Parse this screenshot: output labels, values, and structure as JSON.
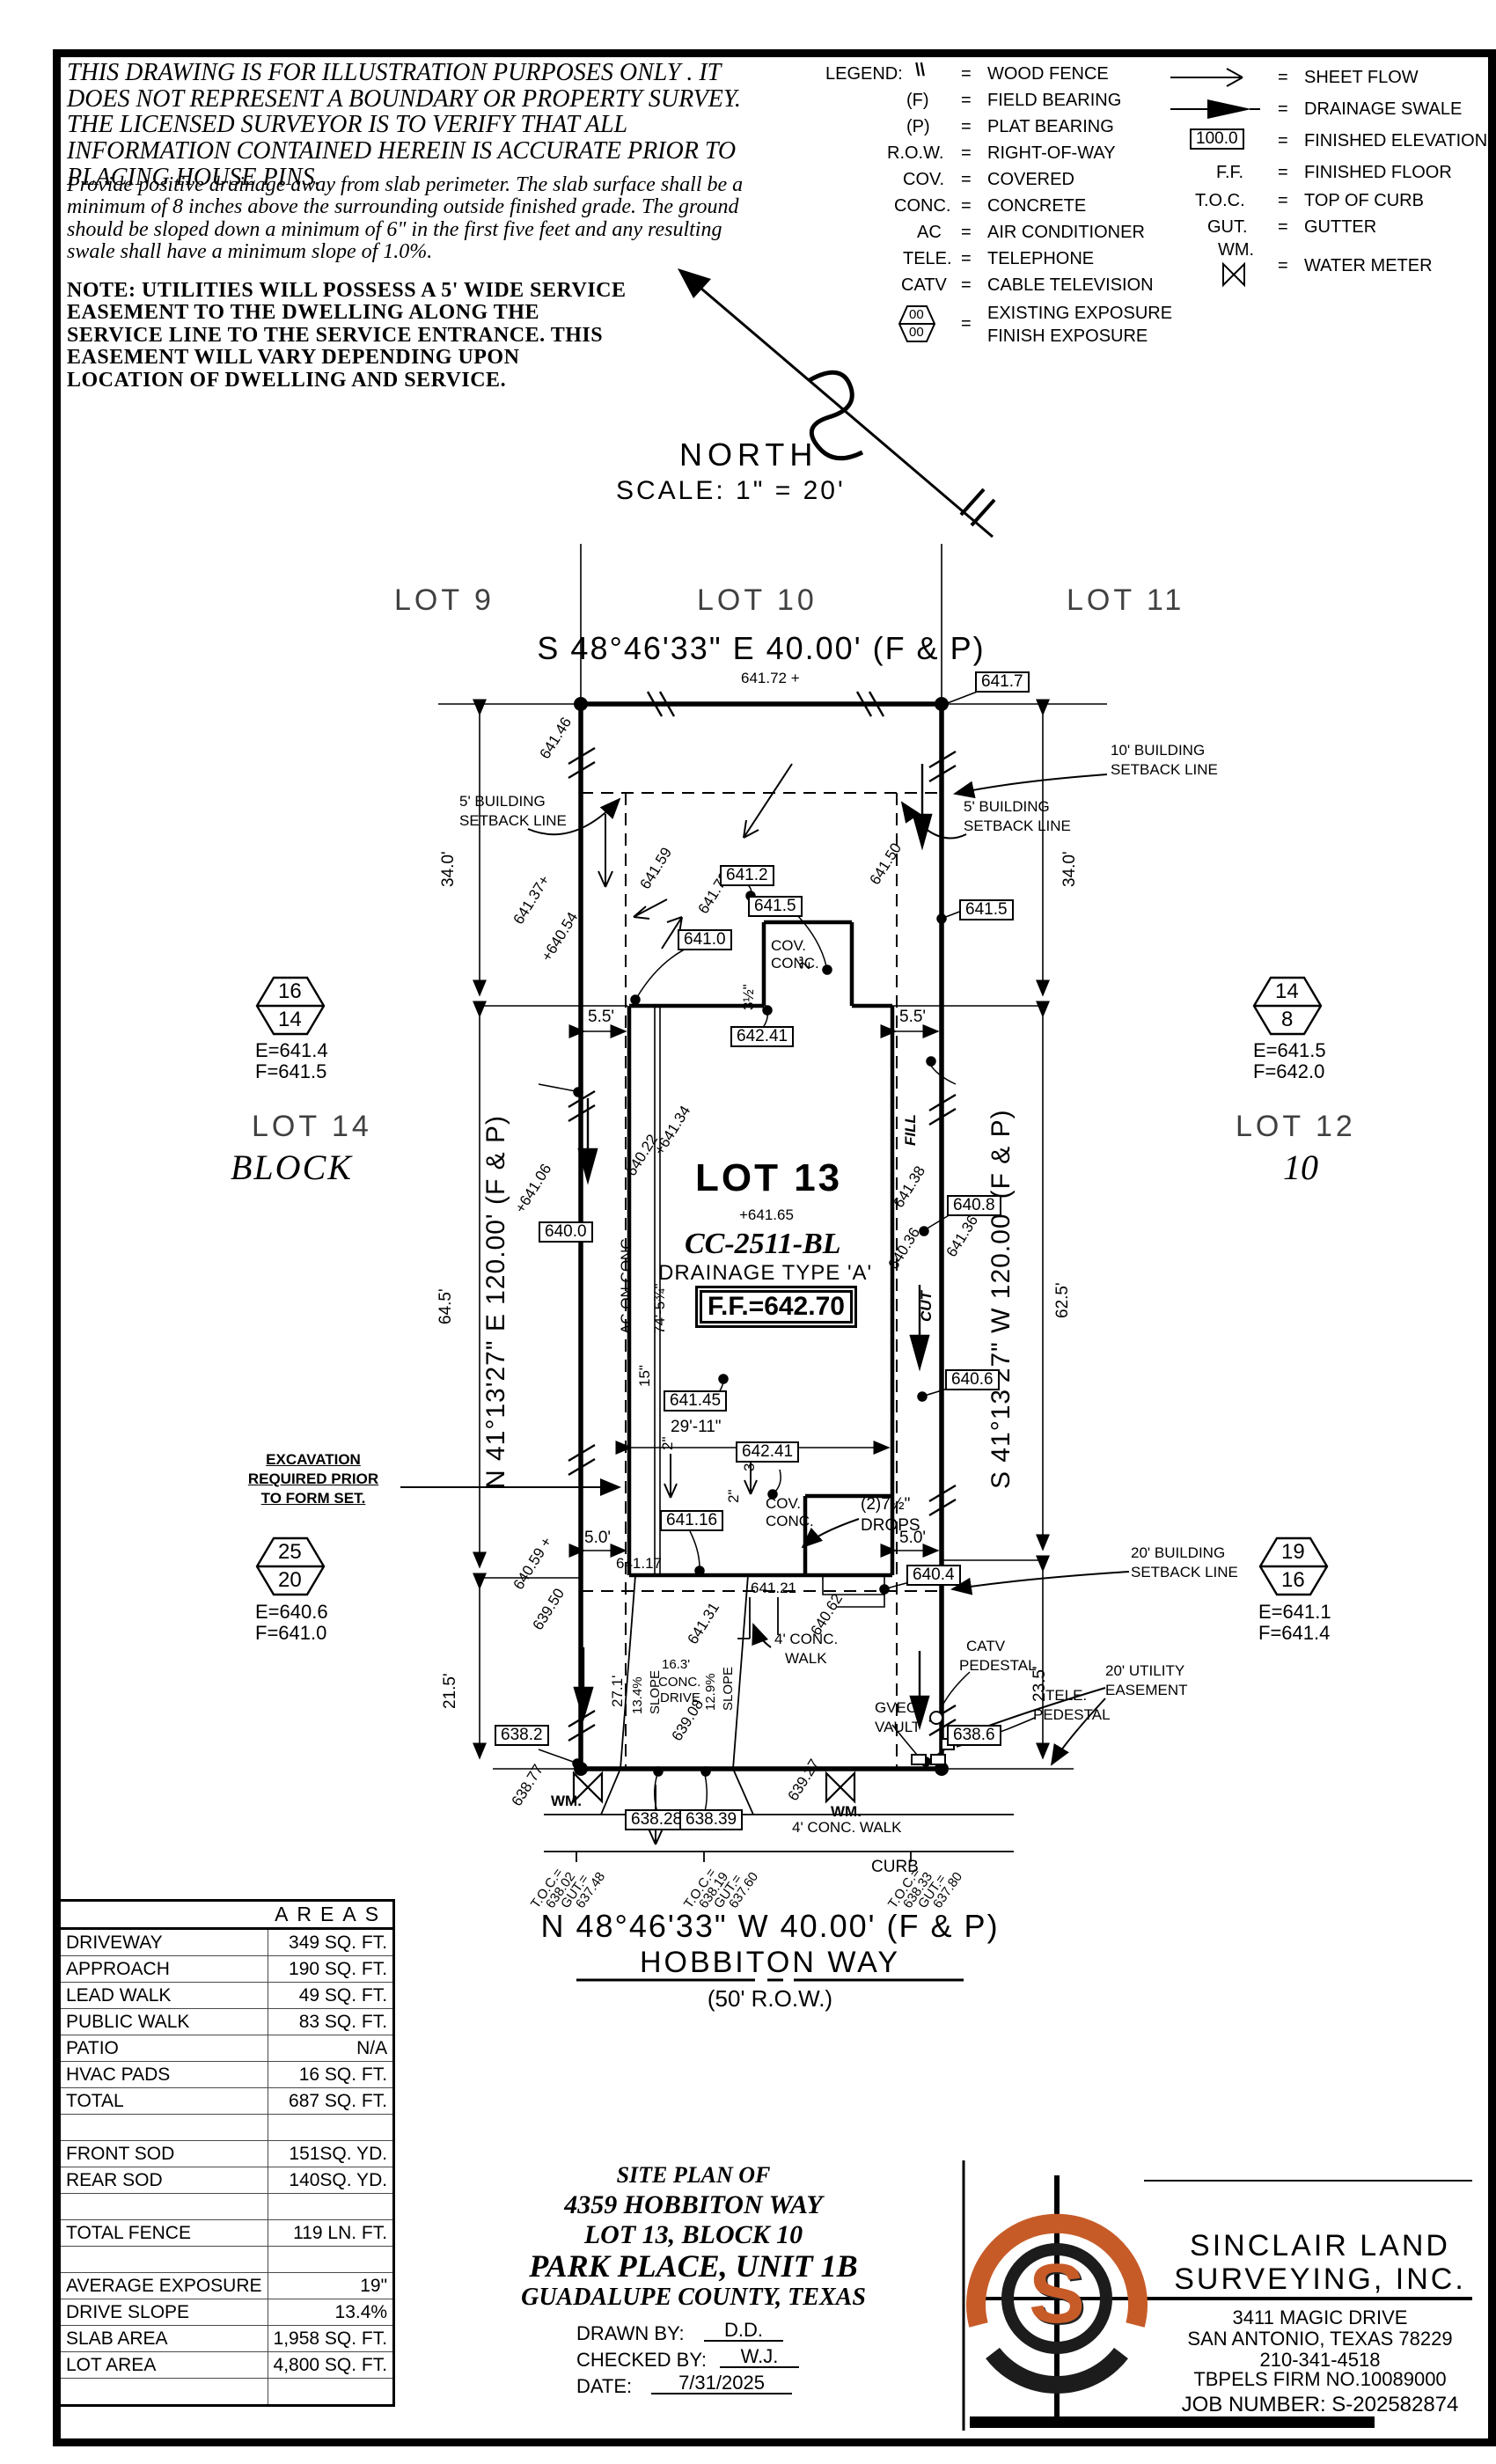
{
  "sheet": {
    "disclaimer_caps": "THIS DRAWING IS FOR ILLUSTRATION PURPOSES ONLY . IT DOES NOT REPRESENT A BOUNDARY OR PROPERTY SURVEY. THE LICENSED SURVEYOR IS TO VERIFY THAT ALL INFORMATION CONTAINED HEREIN IS ACCURATE PRIOR TO PLACING HOUSE PINS.",
    "drainage_note": "Provide positive drainage away from slab perimeter. The slab surface shall be a minimum of 8 inches above the surrounding outside finished grade. The ground should be sloped down a minimum of 6\" in the first five feet and any resulting swale shall have a minimum slope of 1.0%.",
    "utility_note": "NOTE: UTILITIES WILL POSSESS A 5' WIDE SERVICE EASEMENT TO THE DWELLING ALONG THE SERVICE LINE TO THE SERVICE ENTRANCE. THIS EASEMENT WILL VARY DEPENDING UPON LOCATION OF DWELLING AND SERVICE."
  },
  "legend": {
    "title": "LEGEND:",
    "left": [
      {
        "sym": "\\\\",
        "label": "WOOD FENCE"
      },
      {
        "sym": "(F)",
        "label": "FIELD BEARING"
      },
      {
        "sym": "(P)",
        "label": "PLAT BEARING"
      },
      {
        "sym": "R.O.W.",
        "label": "RIGHT-OF-WAY"
      },
      {
        "sym": "COV.",
        "label": "COVERED"
      },
      {
        "sym": "CONC.",
        "label": "CONCRETE"
      },
      {
        "sym": "AC",
        "label": "AIR CONDITIONER"
      },
      {
        "sym": "TELE.",
        "label": "TELEPHONE"
      },
      {
        "sym": "CATV",
        "label": "CABLE TELEVISION"
      }
    ],
    "hex": {
      "top": "00",
      "bottom": "00",
      "label1": "EXISTING EXPOSURE",
      "label2": "FINISH EXPOSURE"
    },
    "right": [
      {
        "sym": "",
        "label": "SHEET FLOW"
      },
      {
        "sym": "",
        "label": "DRAINAGE SWALE"
      },
      {
        "sym": "100.0",
        "label": "FINISHED ELEVATION"
      },
      {
        "sym": "F.F.",
        "label": "FINISHED FLOOR"
      },
      {
        "sym": "T.O.C.",
        "label": "TOP OF CURB"
      },
      {
        "sym": "GUT.",
        "label": "GUTTER"
      },
      {
        "sym": "WM.",
        "label": "WATER METER"
      }
    ]
  },
  "north": {
    "label": "NORTH",
    "scale": "SCALE: 1\" = 20'"
  },
  "plan": {
    "labels": {
      "lot9": "LOT 9",
      "lot10": "LOT 10",
      "lot11": "LOT 11",
      "bearing_top": "S 48°46'33\" E 40.00' (F & P)",
      "r641_72": "641.72 +",
      "b641_7": "641.7",
      "r641_46": "641.46",
      "s10a": "10' BUILDING",
      "s10b": "SETBACK LINE",
      "d34l": "34.0'",
      "d34r": "34.0'",
      "s5la": "5' BUILDING",
      "s5lb": "SETBACK LINE",
      "s5ra": "5' BUILDING",
      "s5rb": "SETBACK LINE",
      "r641_59": "641.59",
      "b641_2": "641.2",
      "r641_73": "641.73",
      "r641_50": "641.50",
      "b641_5a": "641.5",
      "b641_5b": "641.5",
      "b641_0a": "641.0",
      "r641_37": "641.37+",
      "r640_54": "+640.54",
      "cov1a": "COV.",
      "cov1b": "CONC.",
      "d2a": "2\"",
      "d3ha": "3½\"",
      "d5_5l": "5.5'",
      "d5_5r": "5.5'",
      "b642_41a": "642.41",
      "lot14": "LOT 14",
      "block": "BLOCK",
      "lot12": "LOT 12",
      "block10": "10",
      "bearingL": "N 41°13'27\" E 120.00' (F & P)",
      "bearingR": "S 41°13'27\" W 120.00' (F & P)",
      "fill": "FILL",
      "cut": "CUT",
      "lot13": "LOT 13",
      "spot65": "+641.65",
      "model": "CC-2511-BL",
      "drainage": "DRAINAGE TYPE 'A'",
      "ff": "F.F.=642.70",
      "r640_22": "640.22",
      "r641_34": "+641.34",
      "r641_06": "+641.06",
      "b640_0": "640.0",
      "acconc": "AC ON CONC.",
      "d74": "74'-5¾\"",
      "r641_38": "641.38",
      "r640_36": "640.36",
      "r641_36": "641.36 +",
      "b640_8": "640.8",
      "d15": "15\"",
      "b641_45": "641.45",
      "d29_11": "29'-11\"",
      "b642_41b": "642.41",
      "d3hb": "3½\"",
      "d2b": "2\"",
      "d2c": "2\"",
      "b640_6": "640.6",
      "cov2a": "COV.",
      "cov2b": "CONC.",
      "drops1": "(2)7½\"",
      "drops2": "DROPS",
      "b641_16": "641.16",
      "d5_0l": "5.0'",
      "d5_0r": "5.0'",
      "e641_17": "641.17",
      "e641_21": "641.21",
      "b640_4": "640.4",
      "s20a": "20' BUILDING",
      "s20b": "SETBACK LINE",
      "ex1": "EXCAVATION",
      "ex2": "REQUIRED PRIOR",
      "ex3": "TO FORM SET.",
      "d64_5": "64.5'",
      "d62_5": "62.5'",
      "d21_5": "21.5'",
      "d23_5": "23.5'",
      "d27_1": "27.1'",
      "r640_59": "640.59 +",
      "r639_50": "639.50",
      "r641_31": "641.31",
      "r640_62": "640.62",
      "slope1a": "13.4%",
      "slope1b": "SLOPE",
      "slope2a": "12.9%",
      "slope2b": "SLOPE",
      "d16_3": "16.3'",
      "dconc": "CONC.",
      "ddrive": "DRIVE",
      "walk1": "4' CONC.",
      "walk2": "WALK",
      "catv1": "CATV",
      "catv2": "PEDESTAL",
      "tele1": "TELE.",
      "tele2": "PEDESTAL",
      "gvec1": "GVEC.",
      "gvec2": "VAULT",
      "uea": "20' UTILITY",
      "ueb": "EASEMENT",
      "r638_77": "638.77",
      "r639_08": "639.08",
      "r639_27": "639.27",
      "b638_2": "638.2",
      "b638_6": "638.6",
      "wm1": "WM.",
      "wm2": "WM.",
      "b638_28": "638.28",
      "b638_39": "638.39",
      "pubwalk": "4' CONC. WALK",
      "curb": "CURB",
      "toc1a": "T.O.C.=",
      "toc1b": "638.02",
      "toc1c": "GUT.=",
      "toc1d": "637.48",
      "toc2a": "T.O.C.=",
      "toc2b": "638.19",
      "toc2c": "GUT.=",
      "toc2d": "637.60",
      "toc3a": "T.O.C.=",
      "toc3b": "638.33",
      "toc3c": "GUT.=",
      "toc3d": "637.80",
      "bearing_bottom": "N 48°46'33\" W 40.00' (F & P)",
      "street": "HOBBITON WAY",
      "row": "(50' R.O.W.)"
    },
    "markers": {
      "hx1t": "16",
      "hx1b": "14",
      "hx1e": "E=641.4",
      "hx1f": "F=641.5",
      "hx2t": "14",
      "hx2b": "8",
      "hx2e": "E=641.5",
      "hx2f": "F=642.0",
      "hx3t": "25",
      "hx3b": "20",
      "hx3e": "E=640.6",
      "hx3f": "F=641.0",
      "hx4t": "19",
      "hx4b": "16",
      "hx4e": "E=641.1",
      "hx4f": "F=641.4"
    }
  },
  "areas": {
    "title": "AREAS",
    "rows": [
      {
        "label": "DRIVEWAY",
        "value": "349 SQ. FT."
      },
      {
        "label": "APPROACH",
        "value": "190 SQ. FT."
      },
      {
        "label": "LEAD WALK",
        "value": "49 SQ. FT."
      },
      {
        "label": "PUBLIC WALK",
        "value": "83 SQ. FT."
      },
      {
        "label": "PATIO",
        "value": "N/A"
      },
      {
        "label": "HVAC PADS",
        "value": "16 SQ. FT."
      },
      {
        "label": "TOTAL",
        "value": "687 SQ. FT."
      },
      {
        "label": "",
        "value": ""
      },
      {
        "label": "FRONT SOD",
        "value": "151SQ. YD."
      },
      {
        "label": "REAR SOD",
        "value": "140SQ. YD."
      },
      {
        "label": "",
        "value": ""
      },
      {
        "label": "TOTAL FENCE",
        "value": "119 LN. FT."
      },
      {
        "label": "",
        "value": ""
      },
      {
        "label": "AVERAGE EXPOSURE",
        "value": "19\""
      },
      {
        "label": "DRIVE SLOPE",
        "value": "13.4%"
      },
      {
        "label": "SLAB AREA",
        "value": "1,958 SQ. FT."
      },
      {
        "label": "LOT AREA",
        "value": "4,800 SQ. FT."
      },
      {
        "label": "",
        "value": ""
      }
    ]
  },
  "title_block": {
    "line1": "SITE PLAN OF",
    "line2": "4359 HOBBITON WAY",
    "line3": "LOT 13, BLOCK 10",
    "line4": "PARK PLACE, UNIT 1B",
    "line5": "GUADALUPE COUNTY, TEXAS",
    "drawn_label": "DRAWN BY:",
    "drawn_value": "D.D.",
    "checked_label": "CHECKED BY:",
    "checked_value": "W.J.",
    "date_label": "DATE:",
    "date_value": "7/31/2025"
  },
  "firm": {
    "logo_letter": "S",
    "name1": "SINCLAIR LAND",
    "name2": "SURVEYING, INC.",
    "addr1": "3411 MAGIC DRIVE",
    "addr2": "SAN ANTONIO, TEXAS 78229",
    "phone": "210-341-4518",
    "tbpels": "TBPELS FIRM NO.10089000",
    "job": "JOB NUMBER: S-202582874",
    "accent_color": "#c75b28"
  }
}
